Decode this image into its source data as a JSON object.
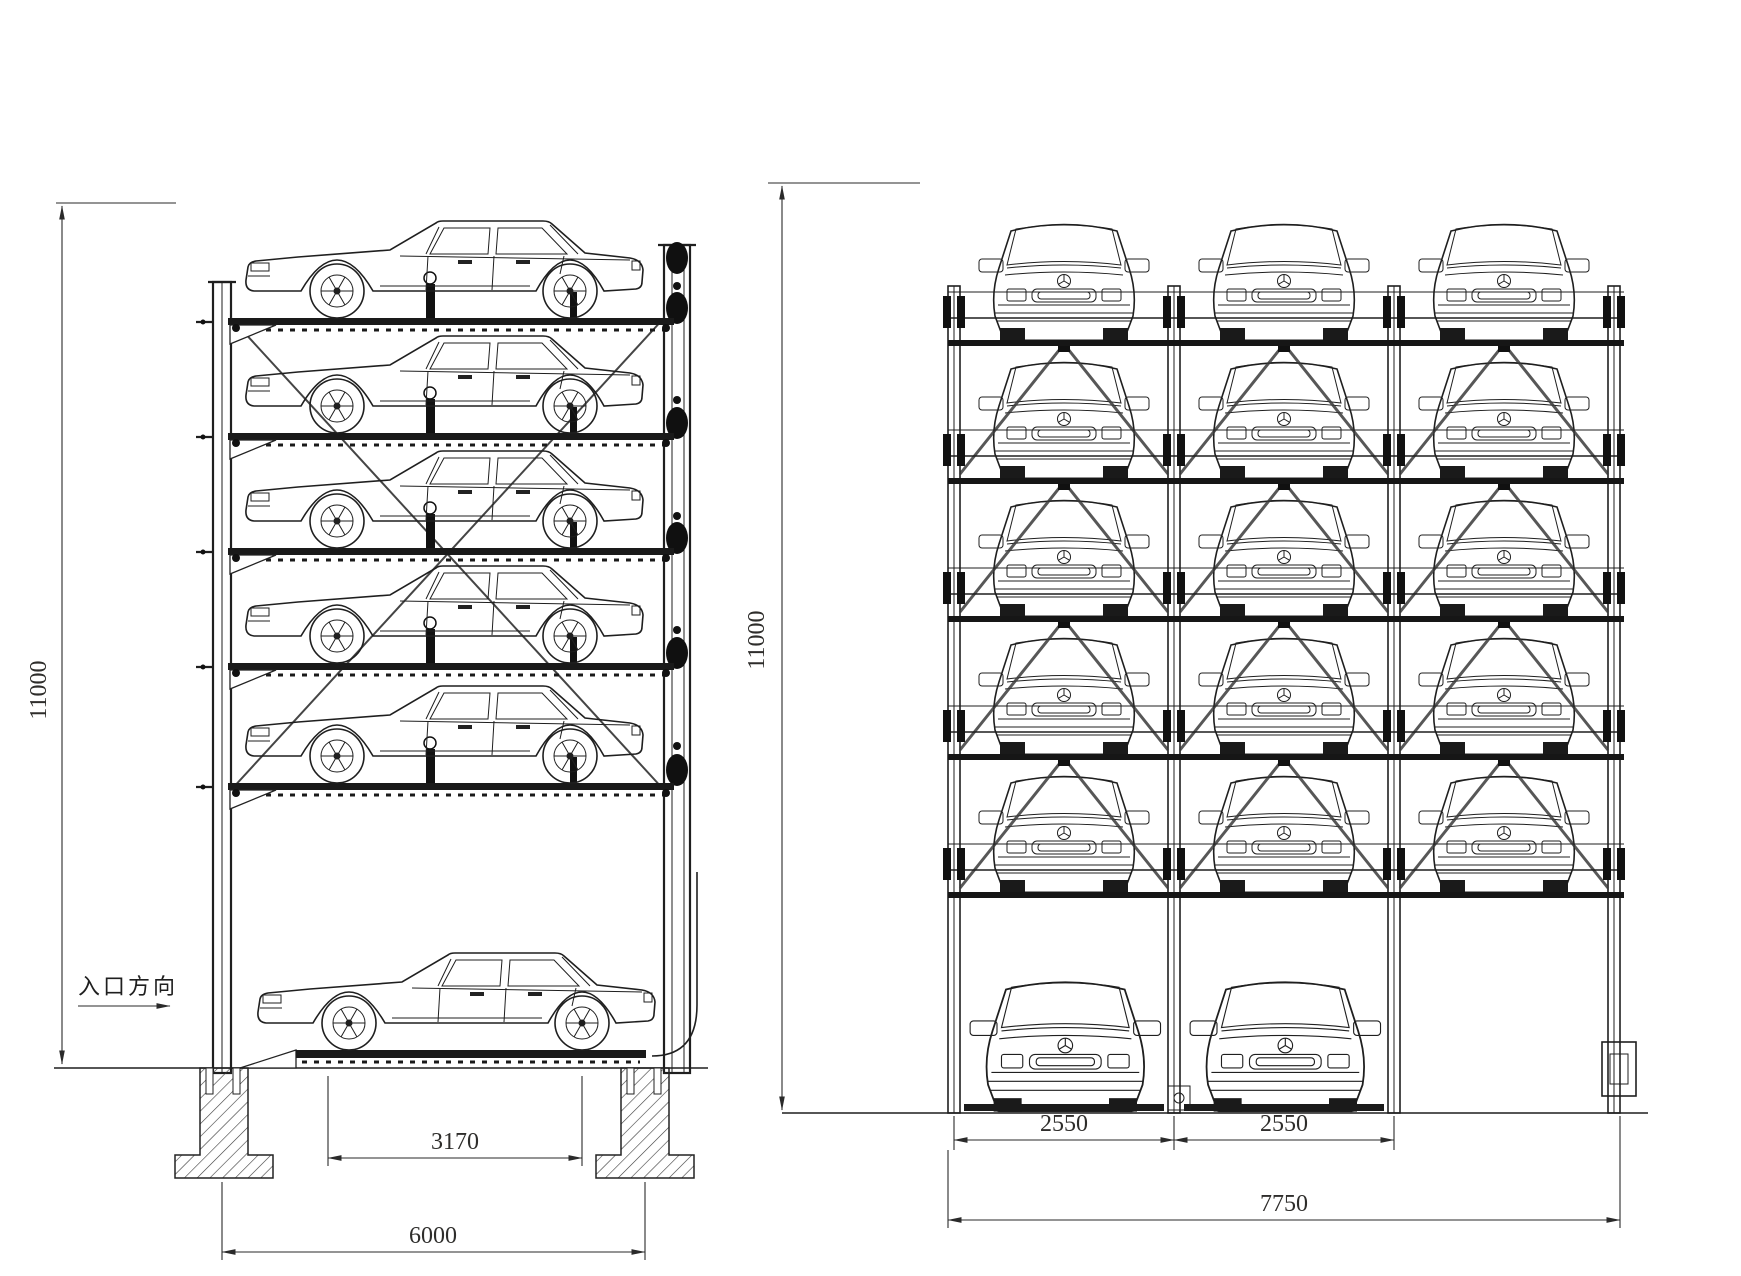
{
  "drawing": {
    "type": "elevation-drawing",
    "subject": "six-level vertical lift car parking system",
    "side_view": {
      "entrance_label": "入口方向",
      "dims": {
        "height": "11000",
        "platform_width": "3170",
        "overall_width": "6000"
      },
      "levels": 6,
      "cars_visible": 6
    },
    "front_view": {
      "dims": {
        "height": "11000",
        "left_bay": "2550",
        "right_bay": "2550",
        "overall_width": "7750"
      },
      "elevated_rows": 5,
      "columns": 3,
      "ground_cars": 2,
      "cars_visible": 17
    },
    "colors": {
      "line": "#1f1f1f",
      "dim_line": "#2a2a2a",
      "text": "#2e2d2b",
      "background": "#ffffff"
    }
  }
}
